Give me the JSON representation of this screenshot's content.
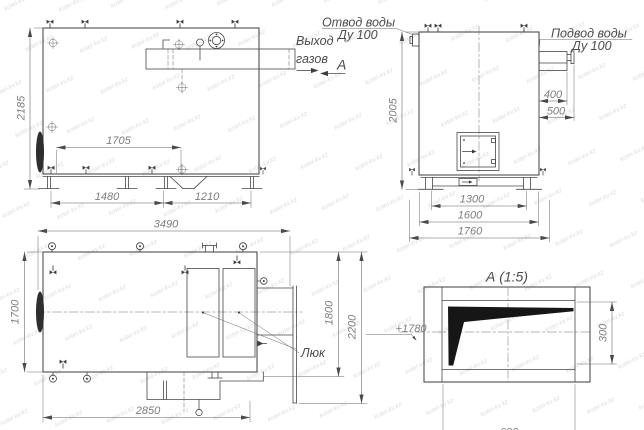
{
  "watermark": {
    "text": "kotel-kv.kz"
  },
  "front_view": {
    "dim_height": "2185",
    "dim_inner": "1705",
    "dim_base_left": "1480",
    "dim_base_right": "1210",
    "gas_label_line1": "Выход",
    "gas_label_line2": "газов",
    "section_label": "А"
  },
  "side_view": {
    "water_outlet_line1": "Отвод воды",
    "water_outlet_line2": "Ду 100",
    "water_inlet_line1": "Подвод воды",
    "water_inlet_line2": "Ду 100",
    "dim_height": "2005",
    "dim_inlet_width": "400",
    "dim_inlet_total": "500",
    "dim_base_inner": "1300",
    "dim_base_mid": "1600",
    "dim_base_outer": "1760"
  },
  "plan_view": {
    "dim_length": "3490",
    "dim_width": "1700",
    "dim_bottom_length": "2850",
    "dim_right_inner": "1800",
    "dim_right_outer": "2200",
    "hatch_label": "Люк"
  },
  "detail_view": {
    "title": "А (1:5)",
    "dim_elevation": "+1780",
    "dim_height": "300",
    "dim_width": "600"
  }
}
